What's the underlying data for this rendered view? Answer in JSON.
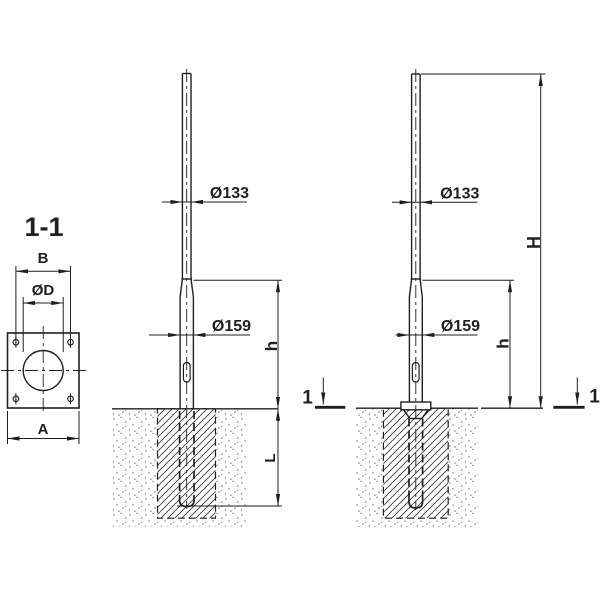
{
  "drawing": {
    "kind": "technical-drawing",
    "line_color": "#1f1f1f",
    "background": "#ffffff"
  },
  "section_view": {
    "title": "1-1",
    "dim_top_width": "B",
    "dim_hole_diameter": "ØD",
    "dim_base_width": "A"
  },
  "elevation_buried": {
    "dia_top": "Ø133",
    "dia_base": "Ø159",
    "dim_above_ground": "h",
    "dim_embedment": "L"
  },
  "elevation_flanged": {
    "dia_top": "Ø133",
    "dia_base": "Ø159",
    "dim_above_ground": "h",
    "dim_total_height": "H",
    "section_marker": "1"
  }
}
